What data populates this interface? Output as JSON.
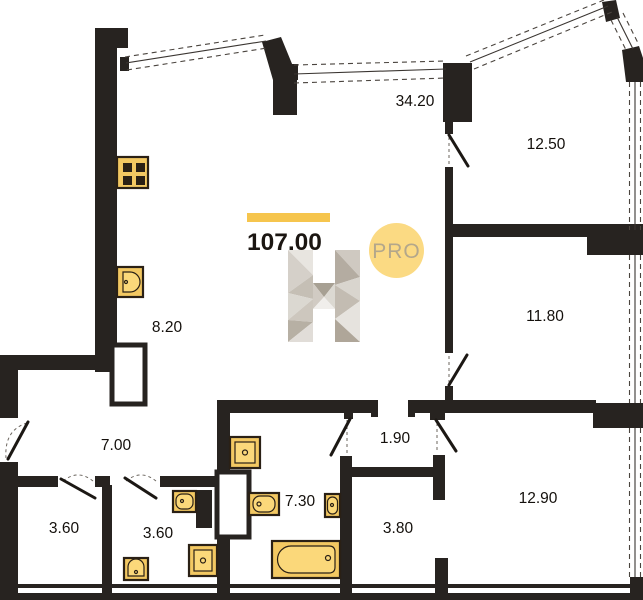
{
  "plan": {
    "total_area": "107.00",
    "badge_label": "PRO",
    "watermark_letter": "H",
    "rooms": [
      {
        "name": "living-kitchen",
        "area": "34.20"
      },
      {
        "name": "kitchen-zone",
        "area": "8.20"
      },
      {
        "name": "bedroom-top-right",
        "area": "12.50"
      },
      {
        "name": "bedroom-right",
        "area": "11.80"
      },
      {
        "name": "bedroom-bottom-right",
        "area": "12.90"
      },
      {
        "name": "hallway",
        "area": "7.00"
      },
      {
        "name": "corridor",
        "area": "1.90"
      },
      {
        "name": "bathroom",
        "area": "7.30"
      },
      {
        "name": "inner-hall",
        "area": "3.80"
      },
      {
        "name": "wc-left",
        "area": "3.60"
      },
      {
        "name": "wc-middle",
        "area": "3.60"
      }
    ],
    "fixtures": [
      "stove",
      "kitchen-sink",
      "toilet",
      "washbasin",
      "bathtub",
      "wardrobe",
      "shaft"
    ],
    "colors": {
      "wall": "#272320",
      "fixture_fill": "#f3c862",
      "fixture_fill_light": "#fbd87a",
      "fixture_stroke": "#2a2015",
      "accent_bar": "#f6c54d",
      "badge_fill": "#fbda83",
      "badge_text": "#b3a78b"
    }
  }
}
